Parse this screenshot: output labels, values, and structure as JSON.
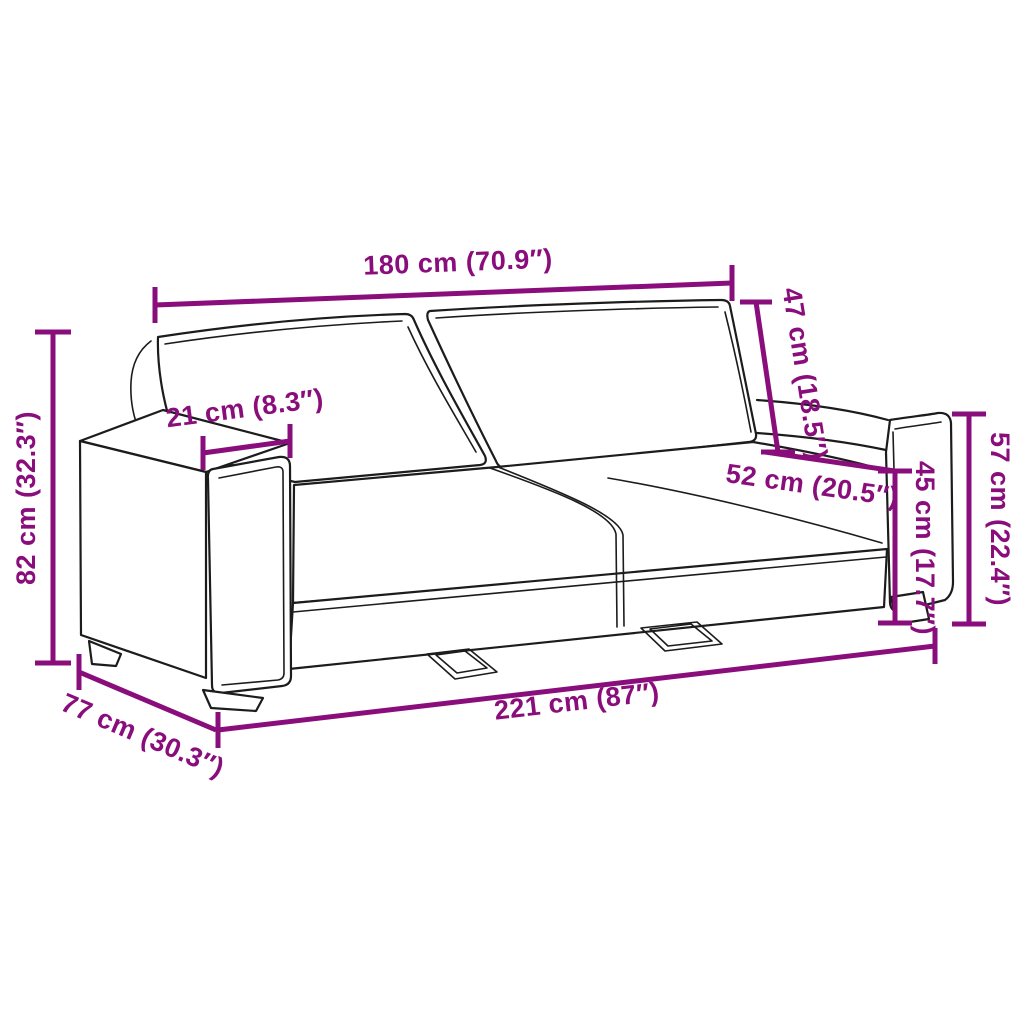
{
  "page": {
    "background": "#ffffff"
  },
  "diagram": {
    "kind": "sofa-dimension-diagram",
    "accent_color": "#8a0d7c",
    "outline_color": "#1c1c1c",
    "dimensions": {
      "back_width": {
        "label": "180 cm (70.9″)",
        "cm": 180,
        "in": 70.9
      },
      "backrest_height": {
        "label": "47 cm (18.5″)",
        "cm": 47,
        "in": 18.5
      },
      "armrest_width": {
        "label": "21 cm (8.3″)",
        "cm": 21,
        "in": 8.3
      },
      "seat_depth": {
        "label": "52 cm (20.5″)",
        "cm": 52,
        "in": 20.5
      },
      "seat_height": {
        "label": "45 cm (17.7″)",
        "cm": 45,
        "in": 17.7
      },
      "armrest_height": {
        "label": "57 cm (22.4″)",
        "cm": 57,
        "in": 22.4
      },
      "overall_height": {
        "label": "82 cm (32.3″)",
        "cm": 82,
        "in": 32.3
      },
      "overall_depth": {
        "label": "77 cm (30.3″)",
        "cm": 77,
        "in": 30.3
      },
      "overall_width": {
        "label": "221 cm (87″)",
        "cm": 221,
        "in": 87
      }
    }
  }
}
